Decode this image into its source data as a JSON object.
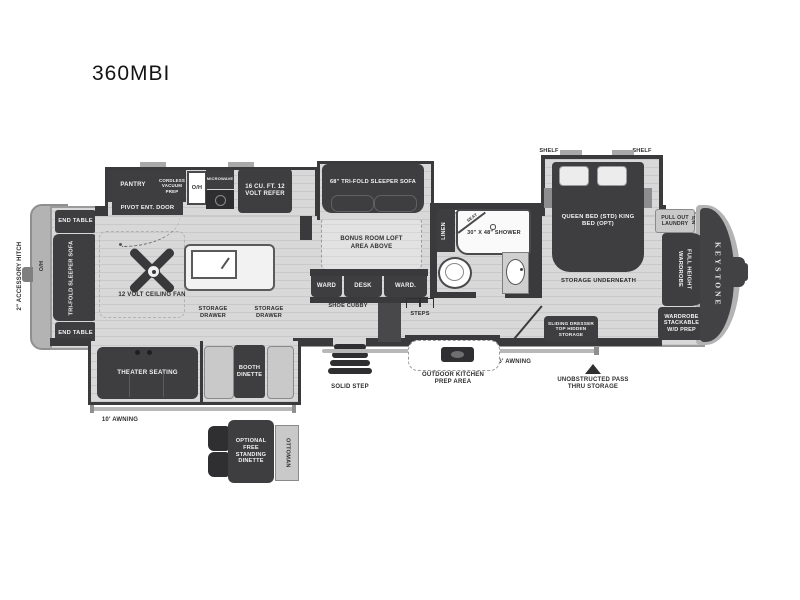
{
  "title": "360MBI",
  "colors": {
    "furniture": "#3e3e40",
    "wall": "#3a3a3c",
    "floor": "#d8d8d8",
    "body_trim": "#b3b3b3"
  },
  "rear": {
    "accessory_hitch": "2\" ACCESSORY HITCH",
    "overhead": "O/H",
    "end_table_top": "END TABLE",
    "sleeper_sofa": "TRI-FOLD SLEEPER SOFA",
    "end_table_bottom": "END TABLE"
  },
  "kitchen": {
    "pantry": "PANTRY",
    "cordless_vacuum": "CORDLESS VACUUM PREP",
    "overhead": "O/H",
    "microwave": "MICROWAVE",
    "refer": "16 CU. FT. 12 VOLT REFER",
    "entry_door": "PIVOT ENT. DOOR",
    "ceiling_fan": "12 VOLT CEILING FAN",
    "storage_drawer_left": "STORAGE DRAWER",
    "storage_drawer_right": "STORAGE DRAWER"
  },
  "living": {
    "theater_seating": "THEATER SEATING",
    "booth_dinette": "BOOTH DINETTE",
    "awning_10": "10' AWNING",
    "optional_dinette": "OPTIONAL FREE STANDING DINETTE",
    "ottoman": "OTTOMAN",
    "solid_step": "SOLID STEP"
  },
  "bonus_room": {
    "sofa_68": "68\" TRI-FOLD SLEEPER SOFA",
    "loft": "BONUS ROOM LOFT AREA ABOVE",
    "ward_left": "WARD",
    "desk": "DESK",
    "ward_right": "WARD.",
    "shoe_cubby": "SHOE CUBBY",
    "steps": "STEPS"
  },
  "bath": {
    "linen": "LINEN",
    "seat": "SEAT",
    "shower": "30\" x 48\" SHOWER"
  },
  "exterior": {
    "outdoor_kitchen": "OUTDOOR KITCHEN PREP AREA",
    "awning_16": "16' AWNING",
    "sliding_dresser": "SLIDING DRESSER TOP HIDDEN STORAGE",
    "pass_thru": "UNOBSTRUCTED PASS THRU STORAGE"
  },
  "bedroom": {
    "shelf_left": "SHELF",
    "shelf_right": "SHELF",
    "bed": "QUEEN BED (STD) KING BED (OPT)",
    "storage_underneath": "STORAGE UNDERNEATH",
    "pull_out_laundry": "PULL OUT LAUNDRY",
    "night_stand": "N/S",
    "full_height_wardrobe": "FULL HEIGHT WARDROBE",
    "wardrobe_wd": "WARDROBE STACKABLE W/D PREP"
  },
  "brand": {
    "keystone": "KEYSTONE"
  }
}
